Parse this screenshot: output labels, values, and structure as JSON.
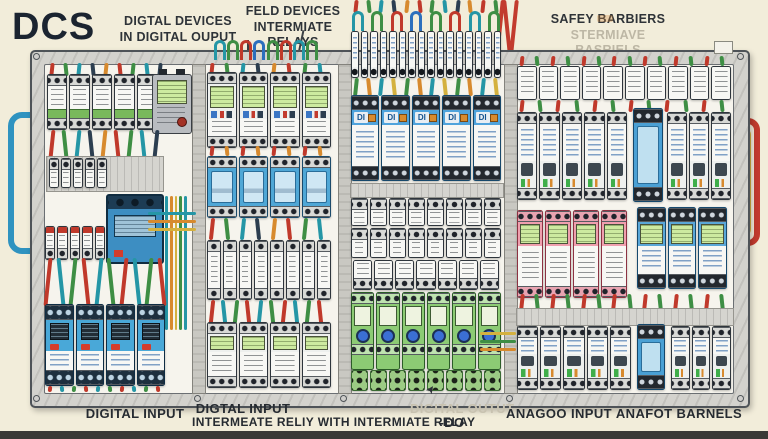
{
  "annotations": {
    "dcs_label": "DCS",
    "top_left_line1": "DIGTAL DEVICES",
    "top_left_line2": "IN DIGITAL OUPUT",
    "top_mid_line1": "FELD DEVICES",
    "top_mid_line2": "INTERMIATE RELAYS",
    "top_right_line1": "SAFEY  BARBIERS",
    "top_right_line2": "STERMIAVE BASRIELS",
    "bottom_digital_input": "DIGITAL INPUT",
    "bottom_di_relay_line1": "DIGTAL INPUT",
    "bottom_di_relay_line2": "INTERMEATE RELIY WITH INTERMIATE RELAY",
    "bottom_digital_output_line1": "DIGITAL OUTUT",
    "bottom_digital_output_line2": "-DO",
    "bottom_analog_input": "ANAGOO INPUT",
    "bottom_analog_barriers": "ANAFOT BARNELS"
  },
  "modules": {
    "di_label": "DI"
  },
  "icons": {
    "cursor_arrow": "➤"
  },
  "counts": {
    "s1_top_wires": 9,
    "s1_row1": 5,
    "s1_mid_wires": 9,
    "s1_row2": 5,
    "s1_row3": 5,
    "s1_pre_relay_wires": 10,
    "s1_relays": 4,
    "s1_bottom_wires": 10,
    "s2_top_wires": 8,
    "s2_meters": 4,
    "s2_wires1": 8,
    "s2_breakers": 4,
    "s2_wires2": 8,
    "s2_narrow": 8,
    "s2_wires3": 10,
    "s2_bottom": 4,
    "s3_stem_wires": 12,
    "s3_loops": 8,
    "s3_terminals": 16,
    "s3_mid_wires": 12,
    "s3_di": 5,
    "s3_rowA": 8,
    "s3_rowB": 8,
    "s3_rowC": 7,
    "s3_green": 6,
    "s3_green_terms": 8,
    "s4_top_wires": 14,
    "s4_top_row": 10,
    "s4_mid_wires": 12,
    "s4_breakers_left": 5,
    "s4_breakers_right": 3,
    "s4_pink": 4,
    "s4_blue_lcd": 3,
    "s4_low_wires": 14,
    "s4_bottom_left": 5,
    "s4_bottom_right": 3,
    "s4_red_drop_wires": 3,
    "s1_bundle": 5
  },
  "colors": {
    "background": "#f2edda",
    "bottom_band": "#3a3a37",
    "cabinet_frame": "#d3d2cd",
    "panel": "#f6f4ed",
    "wire_red": "#c0392b",
    "wire_green": "#3e8e44",
    "wire_teal": "#2596a6",
    "wire_navy": "#2c3e50",
    "wire_orange": "#d78a2e",
    "wire_yellow": "#d4b13f",
    "module_blue": "#4aa5d9",
    "module_green": "#8ccb74",
    "module_pink": "#ef9fae",
    "lcd_green": "#cdeaa0",
    "conduit_blue": "#2f93c0",
    "conduit_red": "#c23b2e",
    "label_dark": "#262b31",
    "label_faint": "#c8c2b0"
  }
}
